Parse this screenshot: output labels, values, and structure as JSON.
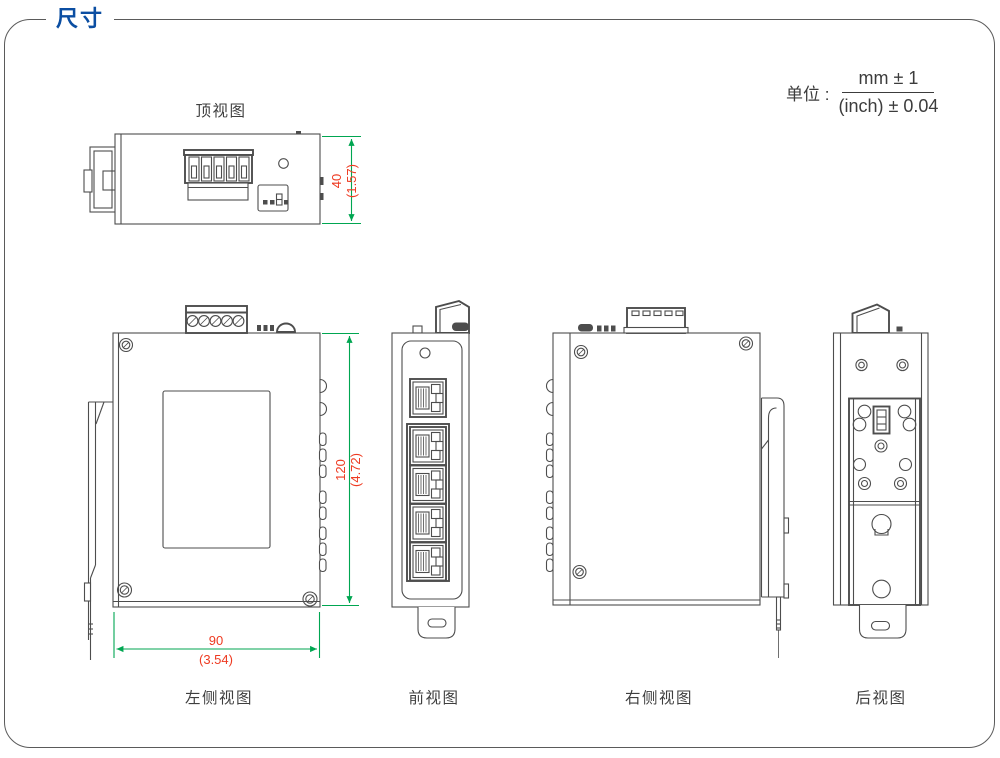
{
  "page": {
    "title": "尺寸"
  },
  "unit_note": {
    "label": "单位 :",
    "numerator": "mm ± 1",
    "denominator": "(inch) ± 0.04"
  },
  "views": {
    "top": {
      "label": "顶视图"
    },
    "left": {
      "label": "左侧视图"
    },
    "front": {
      "label": "前视图"
    },
    "right": {
      "label": "右侧视图"
    },
    "rear": {
      "label": "后视图"
    }
  },
  "dimensions": {
    "depth": {
      "mm": "40",
      "inch": "(1.57)"
    },
    "height": {
      "mm": "120",
      "inch": "(4.72)"
    },
    "width": {
      "mm": "90",
      "inch": "(3.54)"
    }
  },
  "colors": {
    "accent_blue": "#0b4ea2",
    "dimension_line_green": "#00a651",
    "dimension_text_red": "#ee3a21",
    "drawing_line_gray": "#4d4d4d"
  }
}
